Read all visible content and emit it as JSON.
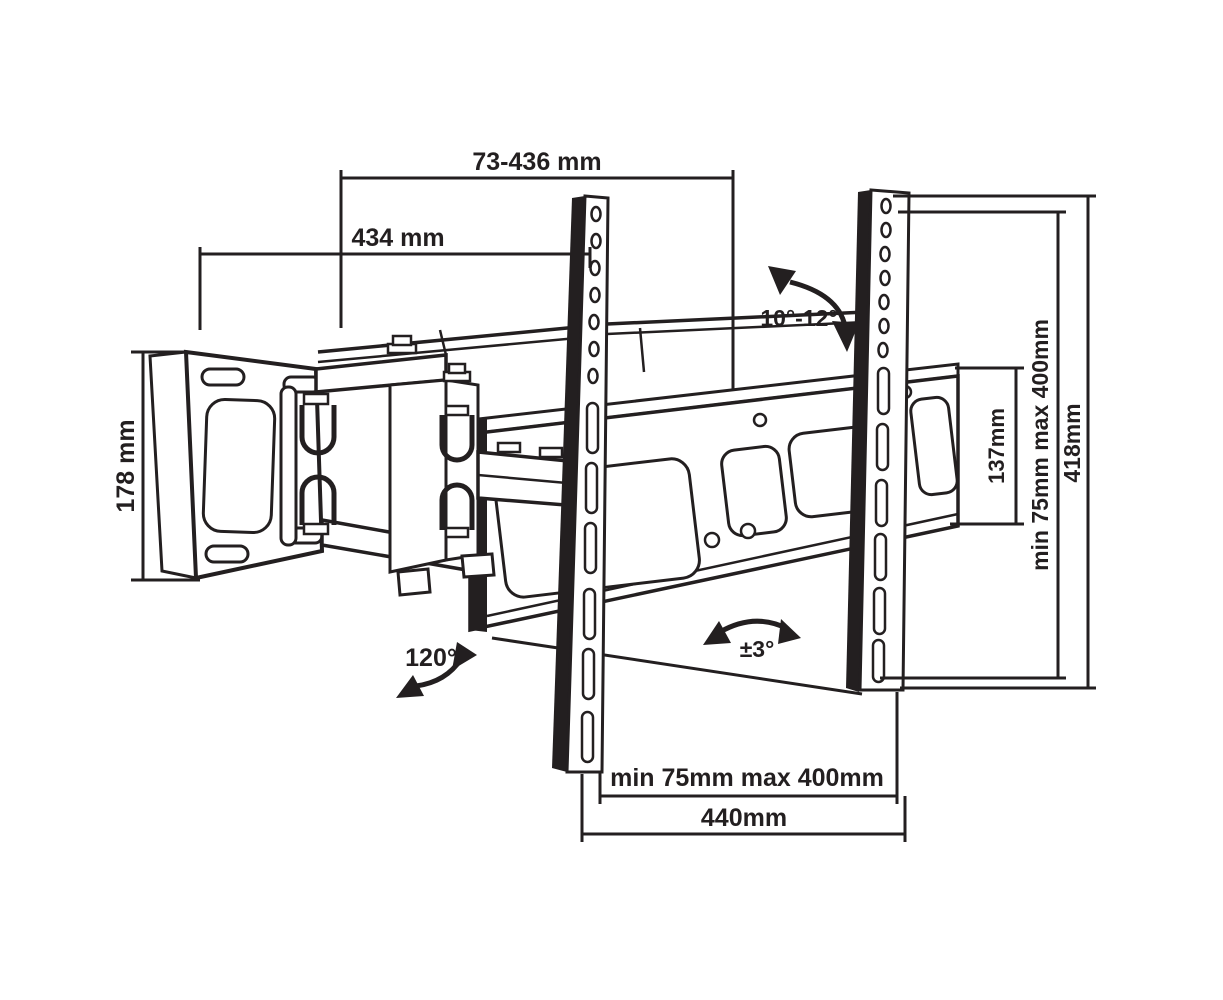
{
  "diagram": {
    "kind": "tv-wall-mount-dimension-drawing",
    "colors": {
      "line": "#231f20",
      "background": "#ffffff"
    },
    "dimensions": {
      "extension_range": "73-436 mm",
      "arm_reach": "434 mm",
      "wall_plate_height": "178 mm",
      "bracket_end_height": "137mm",
      "vesa_vertical_range": "min 75mm max 400mm",
      "rail_height": "418mm",
      "vesa_horizontal_range": "min 75mm max 400mm",
      "bracket_width": "440mm"
    },
    "angles": {
      "tilt": "10°-12°",
      "swivel": "120°",
      "level_adjust": "±3°"
    }
  }
}
